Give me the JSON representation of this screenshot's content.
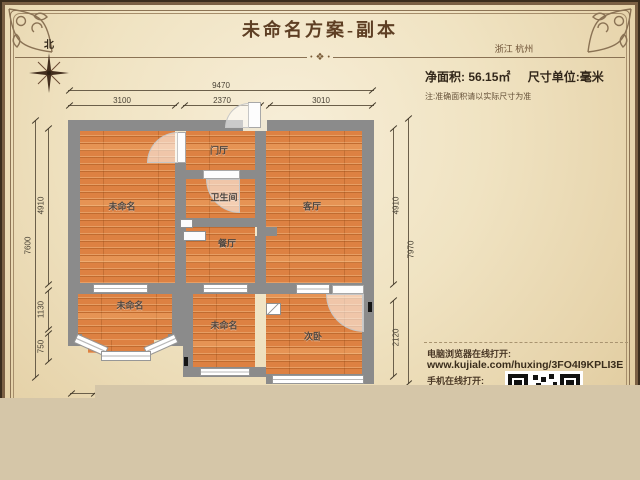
{
  "header": {
    "title": "未命名方案-副本",
    "location": "浙江 杭州",
    "divider_dot": "•",
    "divider_ornament": "❖"
  },
  "info": {
    "area_label": "净面积:",
    "area_value": "56.15㎡",
    "unit_label": "尺寸单位:毫米",
    "note": "注:准确面积请以实际尺寸为准"
  },
  "compass": {
    "north_label": "北"
  },
  "rooms": [
    {
      "name": "未命名"
    },
    {
      "name": "门厅"
    },
    {
      "name": "卫生间"
    },
    {
      "name": "客厅"
    },
    {
      "name": "餐厅"
    },
    {
      "name": "未命名"
    },
    {
      "name": "未命名"
    },
    {
      "name": "次卧"
    }
  ],
  "dimensions": {
    "top_total": "9470",
    "top_segments": [
      "3100",
      "2370",
      "3010"
    ],
    "left_total": "7600",
    "left_segments": [
      "4910",
      "1130",
      "750"
    ],
    "right_total": "7970",
    "right_segments": [
      "4910",
      "2120"
    ]
  },
  "links": {
    "desktop_label": "电脑浏览器在线打开:",
    "url": "www.kujiale.com/huxing/3FO4I9KPLI3E",
    "mobile_label": "手机在线打开:"
  },
  "colors": {
    "wall": "#8b8b8b",
    "floor": "#dd8142",
    "parchment": "#f0e3c2",
    "band": "#d5c6a8",
    "accent": "#5e3f24"
  }
}
